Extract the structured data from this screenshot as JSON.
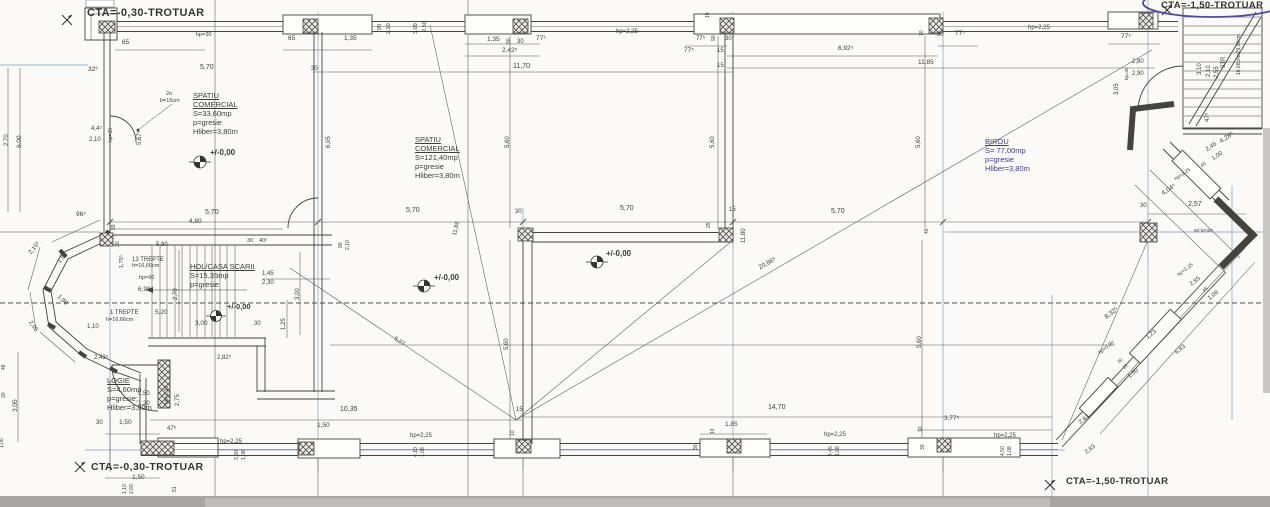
{
  "drawing": {
    "kind": "architectural floor plan (scan)",
    "paper_color": "#fbfaf6",
    "line_color": "#45443c",
    "grid_color": "#90b7d6",
    "pen_ink_color": "#4a4aaa",
    "scan_strip_color": "#a7a5a2",
    "level_value": "+/-0,00"
  },
  "site_labels": {
    "top_left": "CTA=-0,30-TROTUAR",
    "top_right": "CTA=-1,50-TROTUAR",
    "bottom_left": "CTA=-0,30-TROTUAR",
    "bottom_right": "CTA=-1,50-TROTUAR"
  },
  "rooms": {
    "commercial1": {
      "title": "SPATIU COMERCIAL",
      "area": "S=33,60mp",
      "floor": "p=gresie",
      "height": "Hliber=3,80m"
    },
    "commercial2": {
      "title": "SPATIU COMERCIAL",
      "area": "S=121,40mp",
      "floor": "p=gresie",
      "height": "Hliber=3,80m"
    },
    "birou": {
      "title": "BIROU",
      "area": "S= 77,00mp",
      "floor": "p=gresie",
      "height": "Hliber=3,80m"
    },
    "hol": {
      "title": "HOL/CASA SCARII",
      "area": "S=15,35mp",
      "floor": "p=gresie"
    },
    "logie": {
      "title": "LOGIE",
      "area": "S=4,60mp",
      "floor": "p=gresie;",
      "height": "Hliber=3,80m"
    }
  },
  "annotations": [
    {
      "t": "65",
      "x": 122,
      "y": 40,
      "s": 6.5
    },
    {
      "t": "hp=30",
      "x": 196,
      "y": 33,
      "s": 5.5
    },
    {
      "t": "32⁵",
      "x": 88,
      "y": 67,
      "s": 6.5
    },
    {
      "t": "5,70",
      "x": 200,
      "y": 64,
      "s": 7
    },
    {
      "t": "30",
      "x": 311,
      "y": 66,
      "s": 6
    },
    {
      "t": "65",
      "x": 288,
      "y": 36,
      "s": 6.5
    },
    {
      "t": "1,35",
      "x": 344,
      "y": 36,
      "s": 6.5
    },
    {
      "t": "2o",
      "x": 166,
      "y": 92,
      "s": 5.5
    },
    {
      "t": "b=15cm",
      "x": 160,
      "y": 99,
      "s": 5.5
    },
    {
      "t": "4,4⁵",
      "x": 91,
      "y": 126,
      "s": 6
    },
    {
      "t": "2,10",
      "x": 89,
      "y": 137,
      "s": 6
    },
    {
      "t": "hp=30",
      "x": 109,
      "y": 142,
      "r": -90,
      "s": 5
    },
    {
      "t": "5,67⁵",
      "x": 137,
      "y": 145,
      "r": -90,
      "s": 6
    },
    {
      "t": "6,05",
      "x": 326,
      "y": 148,
      "r": -90,
      "s": 6
    },
    {
      "t": "6,00",
      "x": 17,
      "y": 148,
      "r": -90,
      "s": 6.5
    },
    {
      "t": "2,70",
      "x": 4,
      "y": 146,
      "r": -90,
      "s": 6
    },
    {
      "t": "96⁵",
      "x": 76,
      "y": 212,
      "s": 6.5
    },
    {
      "t": "90",
      "x": 378,
      "y": 30,
      "r": -90,
      "s": 5.5
    },
    {
      "t": "2,10",
      "x": 387,
      "y": 34,
      "r": -90,
      "s": 5.5
    },
    {
      "t": "3,00",
      "x": 414,
      "y": 34,
      "r": -90,
      "s": 5.5
    },
    {
      "t": "2,50",
      "x": 423,
      "y": 32,
      "r": -90,
      "s": 5.5
    },
    {
      "t": "1,35",
      "x": 487,
      "y": 37,
      "s": 6.5
    },
    {
      "t": "90",
      "x": 507,
      "y": 44,
      "r": -90,
      "s": 5
    },
    {
      "t": "30",
      "x": 517,
      "y": 39,
      "s": 6
    },
    {
      "t": "77⁵",
      "x": 536,
      "y": 36,
      "s": 6.5
    },
    {
      "t": "2,42⁵",
      "x": 502,
      "y": 48,
      "s": 6.5
    },
    {
      "t": "11,70",
      "x": 513,
      "y": 63,
      "s": 7
    },
    {
      "t": "hp=2,25",
      "x": 616,
      "y": 29,
      "s": 6
    },
    {
      "t": "5,60",
      "x": 505,
      "y": 148,
      "r": -90,
      "s": 6
    },
    {
      "t": "15",
      "x": 706,
      "y": 18,
      "r": -90,
      "s": 5
    },
    {
      "t": "77⁵",
      "x": 696,
      "y": 36,
      "s": 6
    },
    {
      "t": "90",
      "x": 712,
      "y": 41,
      "r": -90,
      "s": 5
    },
    {
      "t": "30",
      "x": 725,
      "y": 36,
      "s": 6
    },
    {
      "t": "77⁵",
      "x": 684,
      "y": 48,
      "s": 6.5
    },
    {
      "t": "15",
      "x": 717,
      "y": 48,
      "s": 6
    },
    {
      "t": "6,92⁵",
      "x": 838,
      "y": 46,
      "s": 6.5
    },
    {
      "t": "15",
      "x": 717,
      "y": 63,
      "s": 6
    },
    {
      "t": "11,85",
      "x": 918,
      "y": 60,
      "s": 6.5
    },
    {
      "t": "10",
      "x": 920,
      "y": 36,
      "r": -90,
      "s": 5
    },
    {
      "t": "30",
      "x": 937,
      "y": 32,
      "s": 6
    },
    {
      "t": "77⁵",
      "x": 955,
      "y": 31,
      "s": 6.5
    },
    {
      "t": "5,60",
      "x": 710,
      "y": 148,
      "r": -90,
      "s": 6
    },
    {
      "t": "5,60",
      "x": 916,
      "y": 148,
      "r": -90,
      "s": 6
    },
    {
      "t": "hp=2,25",
      "x": 1028,
      "y": 25,
      "s": 6
    },
    {
      "t": "77⁵",
      "x": 1121,
      "y": 34,
      "s": 6.5
    },
    {
      "t": "3,05",
      "x": 1114,
      "y": 95,
      "r": -90,
      "s": 6
    },
    {
      "t": "2,80",
      "x": 1132,
      "y": 59,
      "s": 6
    },
    {
      "t": "2,90",
      "x": 1132,
      "y": 71,
      "s": 6
    },
    {
      "t": "hp=30",
      "x": 1125,
      "y": 80,
      "r": -90,
      "s": 4.5
    },
    {
      "t": "3,10",
      "x": 1197,
      "y": 75,
      "r": -90,
      "s": 6
    },
    {
      "t": "2,10",
      "x": 1206,
      "y": 77,
      "r": -90,
      "s": 6
    },
    {
      "t": "2,55",
      "x": 1214,
      "y": 78,
      "r": -90,
      "s": 6
    },
    {
      "t": "9TR",
      "x": 1221,
      "y": 68,
      "r": -90,
      "s": 6
    },
    {
      "t": "16,66cmx29,00cm",
      "x": 1237,
      "y": 75,
      "r": -90,
      "s": 5
    },
    {
      "t": "47⁵",
      "x": 1205,
      "y": 122,
      "r": -90,
      "s": 6
    },
    {
      "t": "4,80",
      "x": 189,
      "y": 219,
      "s": 6.5
    },
    {
      "t": "5,70",
      "x": 205,
      "y": 209,
      "s": 7
    },
    {
      "t": "5,70",
      "x": 406,
      "y": 207,
      "s": 7
    },
    {
      "t": "30",
      "x": 515,
      "y": 209,
      "s": 6
    },
    {
      "t": "5,70",
      "x": 620,
      "y": 205,
      "s": 7
    },
    {
      "t": "15",
      "x": 729,
      "y": 207,
      "s": 6
    },
    {
      "t": "5,70",
      "x": 831,
      "y": 208,
      "s": 7
    },
    {
      "t": "25",
      "x": 707,
      "y": 228,
      "r": -90,
      "s": 5
    },
    {
      "t": "11,80",
      "x": 741,
      "y": 243,
      "r": -90,
      "s": 6
    },
    {
      "t": "40",
      "x": 925,
      "y": 234,
      "r": -90,
      "s": 5
    },
    {
      "t": "30",
      "x": 1140,
      "y": 203,
      "s": 6
    },
    {
      "t": "2,57",
      "x": 1188,
      "y": 201,
      "s": 7
    },
    {
      "t": "20,86⁵",
      "x": 758,
      "y": 266,
      "r": -29,
      "s": 6.5
    },
    {
      "t": "11,86",
      "x": 452,
      "y": 235,
      "r": -77,
      "s": 6
    },
    {
      "t": "5,27",
      "x": 396,
      "y": 336,
      "r": 34,
      "s": 6
    },
    {
      "t": "90",
      "x": 339,
      "y": 248,
      "r": -90,
      "s": 5
    },
    {
      "t": "2,10",
      "x": 346,
      "y": 250,
      "r": -90,
      "s": 5
    },
    {
      "t": "30",
      "x": 247,
      "y": 239,
      "s": 5.5
    },
    {
      "t": "40⁵",
      "x": 259,
      "y": 239,
      "s": 5.5
    },
    {
      "t": "+/-0,00",
      "x": 210,
      "y": 149,
      "s": 8,
      "b": 1,
      "n": "level-marker-label"
    },
    {
      "t": "+/-0,00",
      "x": 434,
      "y": 274,
      "s": 8,
      "b": 1,
      "n": "level-marker-label"
    },
    {
      "t": "+/-0,00",
      "x": 606,
      "y": 250,
      "s": 8,
      "b": 1,
      "n": "level-marker-label"
    },
    {
      "t": "+/-0,00",
      "x": 227,
      "y": 303,
      "s": 7.5,
      "b": 1,
      "n": "level-marker-label"
    },
    {
      "t": "5,80",
      "x": 156,
      "y": 242,
      "s": 6
    },
    {
      "t": "13 TREPTE",
      "x": 132,
      "y": 257,
      "s": 6,
      "n": "stair-note"
    },
    {
      "t": "h=16,66cm",
      "x": 132,
      "y": 264,
      "s": 5.5,
      "n": "stair-note"
    },
    {
      "t": "hp=90",
      "x": 139,
      "y": 276,
      "s": 5.5
    },
    {
      "t": "6,98",
      "x": 138,
      "y": 287,
      "s": 6.5
    },
    {
      "t": "1,75⁵",
      "x": 120,
      "y": 268,
      "r": -90,
      "s": 5.5
    },
    {
      "t": "2,70",
      "x": 173,
      "y": 300,
      "r": -90,
      "s": 6
    },
    {
      "t": "1,45",
      "x": 262,
      "y": 271,
      "s": 6
    },
    {
      "t": "2,30",
      "x": 262,
      "y": 280,
      "s": 6
    },
    {
      "t": "3,00",
      "x": 295,
      "y": 300,
      "r": -90,
      "s": 6
    },
    {
      "t": "5,20",
      "x": 155,
      "y": 310,
      "s": 6.5
    },
    {
      "t": "1 TREPTE",
      "x": 110,
      "y": 310,
      "s": 6,
      "n": "stair-note"
    },
    {
      "t": "h=16,66cm",
      "x": 106,
      "y": 318,
      "s": 5.5,
      "n": "stair-note"
    },
    {
      "t": "3,00",
      "x": 195,
      "y": 321,
      "s": 6.5
    },
    {
      "t": "30",
      "x": 254,
      "y": 321,
      "s": 6
    },
    {
      "t": "1,25",
      "x": 281,
      "y": 330,
      "r": -90,
      "s": 6
    },
    {
      "t": "1,10",
      "x": 87,
      "y": 324,
      "s": 6
    },
    {
      "t": "2,43⁵",
      "x": 94,
      "y": 355,
      "s": 6
    },
    {
      "t": "2,82⁵",
      "x": 217,
      "y": 355,
      "s": 6
    },
    {
      "t": "55",
      "x": 112,
      "y": 230,
      "r": -90,
      "s": 5
    },
    {
      "t": "30",
      "x": 116,
      "y": 247,
      "r": -90,
      "s": 5
    },
    {
      "t": "2,10⁵",
      "x": 28,
      "y": 252,
      "r": -52,
      "s": 6
    },
    {
      "t": "1,56",
      "x": 57,
      "y": 261,
      "r": -52,
      "s": 6
    },
    {
      "t": "1,98",
      "x": 60,
      "y": 294,
      "r": 45,
      "s": 6
    },
    {
      "t": "2,05",
      "x": 32,
      "y": 320,
      "r": 55,
      "s": 6
    },
    {
      "t": "1,50",
      "x": 138,
      "y": 391,
      "s": 6
    },
    {
      "t": "1,20",
      "x": 138,
      "y": 401,
      "s": 6
    },
    {
      "t": "hp=2,15",
      "x": 165,
      "y": 404,
      "r": -90,
      "s": 5
    },
    {
      "t": "2,75",
      "x": 175,
      "y": 406,
      "r": -90,
      "s": 6
    },
    {
      "t": "30",
      "x": 96,
      "y": 420,
      "s": 6
    },
    {
      "t": "1,50",
      "x": 119,
      "y": 420,
      "s": 6.5
    },
    {
      "t": "47⁵",
      "x": 167,
      "y": 426,
      "s": 6
    },
    {
      "t": "hp=2,25",
      "x": 220,
      "y": 439,
      "s": 6
    },
    {
      "t": "3,30",
      "x": 235,
      "y": 460,
      "r": -90,
      "s": 5
    },
    {
      "t": "1,08",
      "x": 242,
      "y": 460,
      "r": -90,
      "s": 5
    },
    {
      "t": "1,50",
      "x": 132,
      "y": 475,
      "s": 6.5
    },
    {
      "t": "3,05",
      "x": 13,
      "y": 412,
      "r": -90,
      "s": 6.5
    },
    {
      "t": "48",
      "x": 2,
      "y": 370,
      "r": -90,
      "s": 5
    },
    {
      "t": "30",
      "x": 2,
      "y": 398,
      "r": -90,
      "s": 5
    },
    {
      "t": "1,06",
      "x": 0,
      "y": 448,
      "r": -90,
      "s": 5
    },
    {
      "t": "1,10",
      "x": 123,
      "y": 494,
      "r": -90,
      "s": 5
    },
    {
      "t": "2,60",
      "x": 130,
      "y": 494,
      "r": -90,
      "s": 5
    },
    {
      "t": "51",
      "x": 173,
      "y": 492,
      "r": -90,
      "s": 5
    },
    {
      "t": "10,35",
      "x": 340,
      "y": 406,
      "s": 7
    },
    {
      "t": "1,50",
      "x": 317,
      "y": 423,
      "s": 6.5
    },
    {
      "t": "hp=2,25",
      "x": 410,
      "y": 433,
      "s": 6
    },
    {
      "t": "4,10",
      "x": 414,
      "y": 457,
      "r": -90,
      "s": 5
    },
    {
      "t": "1,08",
      "x": 421,
      "y": 457,
      "r": -90,
      "s": 5
    },
    {
      "t": "15",
      "x": 516,
      "y": 407,
      "s": 6
    },
    {
      "t": "10",
      "x": 511,
      "y": 436,
      "r": -90,
      "s": 5
    },
    {
      "t": "1,85",
      "x": 725,
      "y": 422,
      "s": 6.5
    },
    {
      "t": "10",
      "x": 711,
      "y": 434,
      "r": -90,
      "s": 5
    },
    {
      "t": "30",
      "x": 694,
      "y": 450,
      "r": -90,
      "s": 5
    },
    {
      "t": "hp=2,25",
      "x": 824,
      "y": 432,
      "s": 6
    },
    {
      "t": "4,45",
      "x": 829,
      "y": 456,
      "r": -90,
      "s": 5
    },
    {
      "t": "1,08",
      "x": 836,
      "y": 456,
      "r": -90,
      "s": 5
    },
    {
      "t": "14,70",
      "x": 768,
      "y": 404,
      "s": 7
    },
    {
      "t": "3,77⁵",
      "x": 944,
      "y": 416,
      "s": 6.5
    },
    {
      "t": "10",
      "x": 919,
      "y": 432,
      "r": -90,
      "s": 5
    },
    {
      "t": "30",
      "x": 921,
      "y": 450,
      "r": -90,
      "s": 5
    },
    {
      "t": "hp=2,25",
      "x": 994,
      "y": 433,
      "s": 6
    },
    {
      "t": "4,50",
      "x": 1001,
      "y": 456,
      "r": -90,
      "s": 5
    },
    {
      "t": "1,08",
      "x": 1008,
      "y": 456,
      "r": -90,
      "s": 5
    },
    {
      "t": "5,60",
      "x": 504,
      "y": 350,
      "r": -90,
      "s": 6
    },
    {
      "t": "5,60",
      "x": 917,
      "y": 348,
      "r": -90,
      "s": 6
    },
    {
      "t": "4,04⁵",
      "x": 1161,
      "y": 192,
      "r": -34,
      "s": 6.5
    },
    {
      "t": "hp=2,25",
      "x": 1174,
      "y": 178,
      "r": -34,
      "s": 5
    },
    {
      "t": "45",
      "x": 1200,
      "y": 165,
      "r": -34,
      "s": 5
    },
    {
      "t": "2,45",
      "x": 1205,
      "y": 148,
      "r": -34,
      "s": 6
    },
    {
      "t": "1,00",
      "x": 1211,
      "y": 157,
      "r": -34,
      "s": 6
    },
    {
      "t": "4,28⁵",
      "x": 1219,
      "y": 140,
      "r": -34,
      "s": 6.5
    },
    {
      "t": "1,12",
      "x": 1243,
      "y": 243,
      "r": -54,
      "s": 6
    },
    {
      "t": "85°59'45''",
      "x": 1194,
      "y": 229,
      "s": 4.5
    },
    {
      "t": "8,32⁵",
      "x": 1104,
      "y": 316,
      "r": -38,
      "s": 6.5
    },
    {
      "t": "hp=2,25",
      "x": 1177,
      "y": 274,
      "r": -38,
      "s": 5
    },
    {
      "t": "2,85",
      "x": 1189,
      "y": 283,
      "r": -38,
      "s": 6
    },
    {
      "t": "45",
      "x": 1202,
      "y": 290,
      "r": -38,
      "s": 5
    },
    {
      "t": "1,08",
      "x": 1207,
      "y": 297,
      "r": -38,
      "s": 6
    },
    {
      "t": "1,23",
      "x": 1145,
      "y": 336,
      "r": -38,
      "s": 6
    },
    {
      "t": "6,83",
      "x": 1174,
      "y": 351,
      "r": -38,
      "s": 6
    },
    {
      "t": "hp=0,90",
      "x": 1098,
      "y": 352,
      "r": -38,
      "s": 5
    },
    {
      "t": "30",
      "x": 1117,
      "y": 361,
      "r": -38,
      "s": 4.5
    },
    {
      "t": "15",
      "x": 1122,
      "y": 367,
      "r": -38,
      "s": 4.5
    },
    {
      "t": "1,50",
      "x": 1127,
      "y": 375,
      "r": -38,
      "s": 6
    },
    {
      "t": "2,63",
      "x": 1078,
      "y": 421,
      "r": -38,
      "s": 6
    },
    {
      "t": "2,83",
      "x": 1084,
      "y": 451,
      "r": -38,
      "s": 6
    }
  ]
}
